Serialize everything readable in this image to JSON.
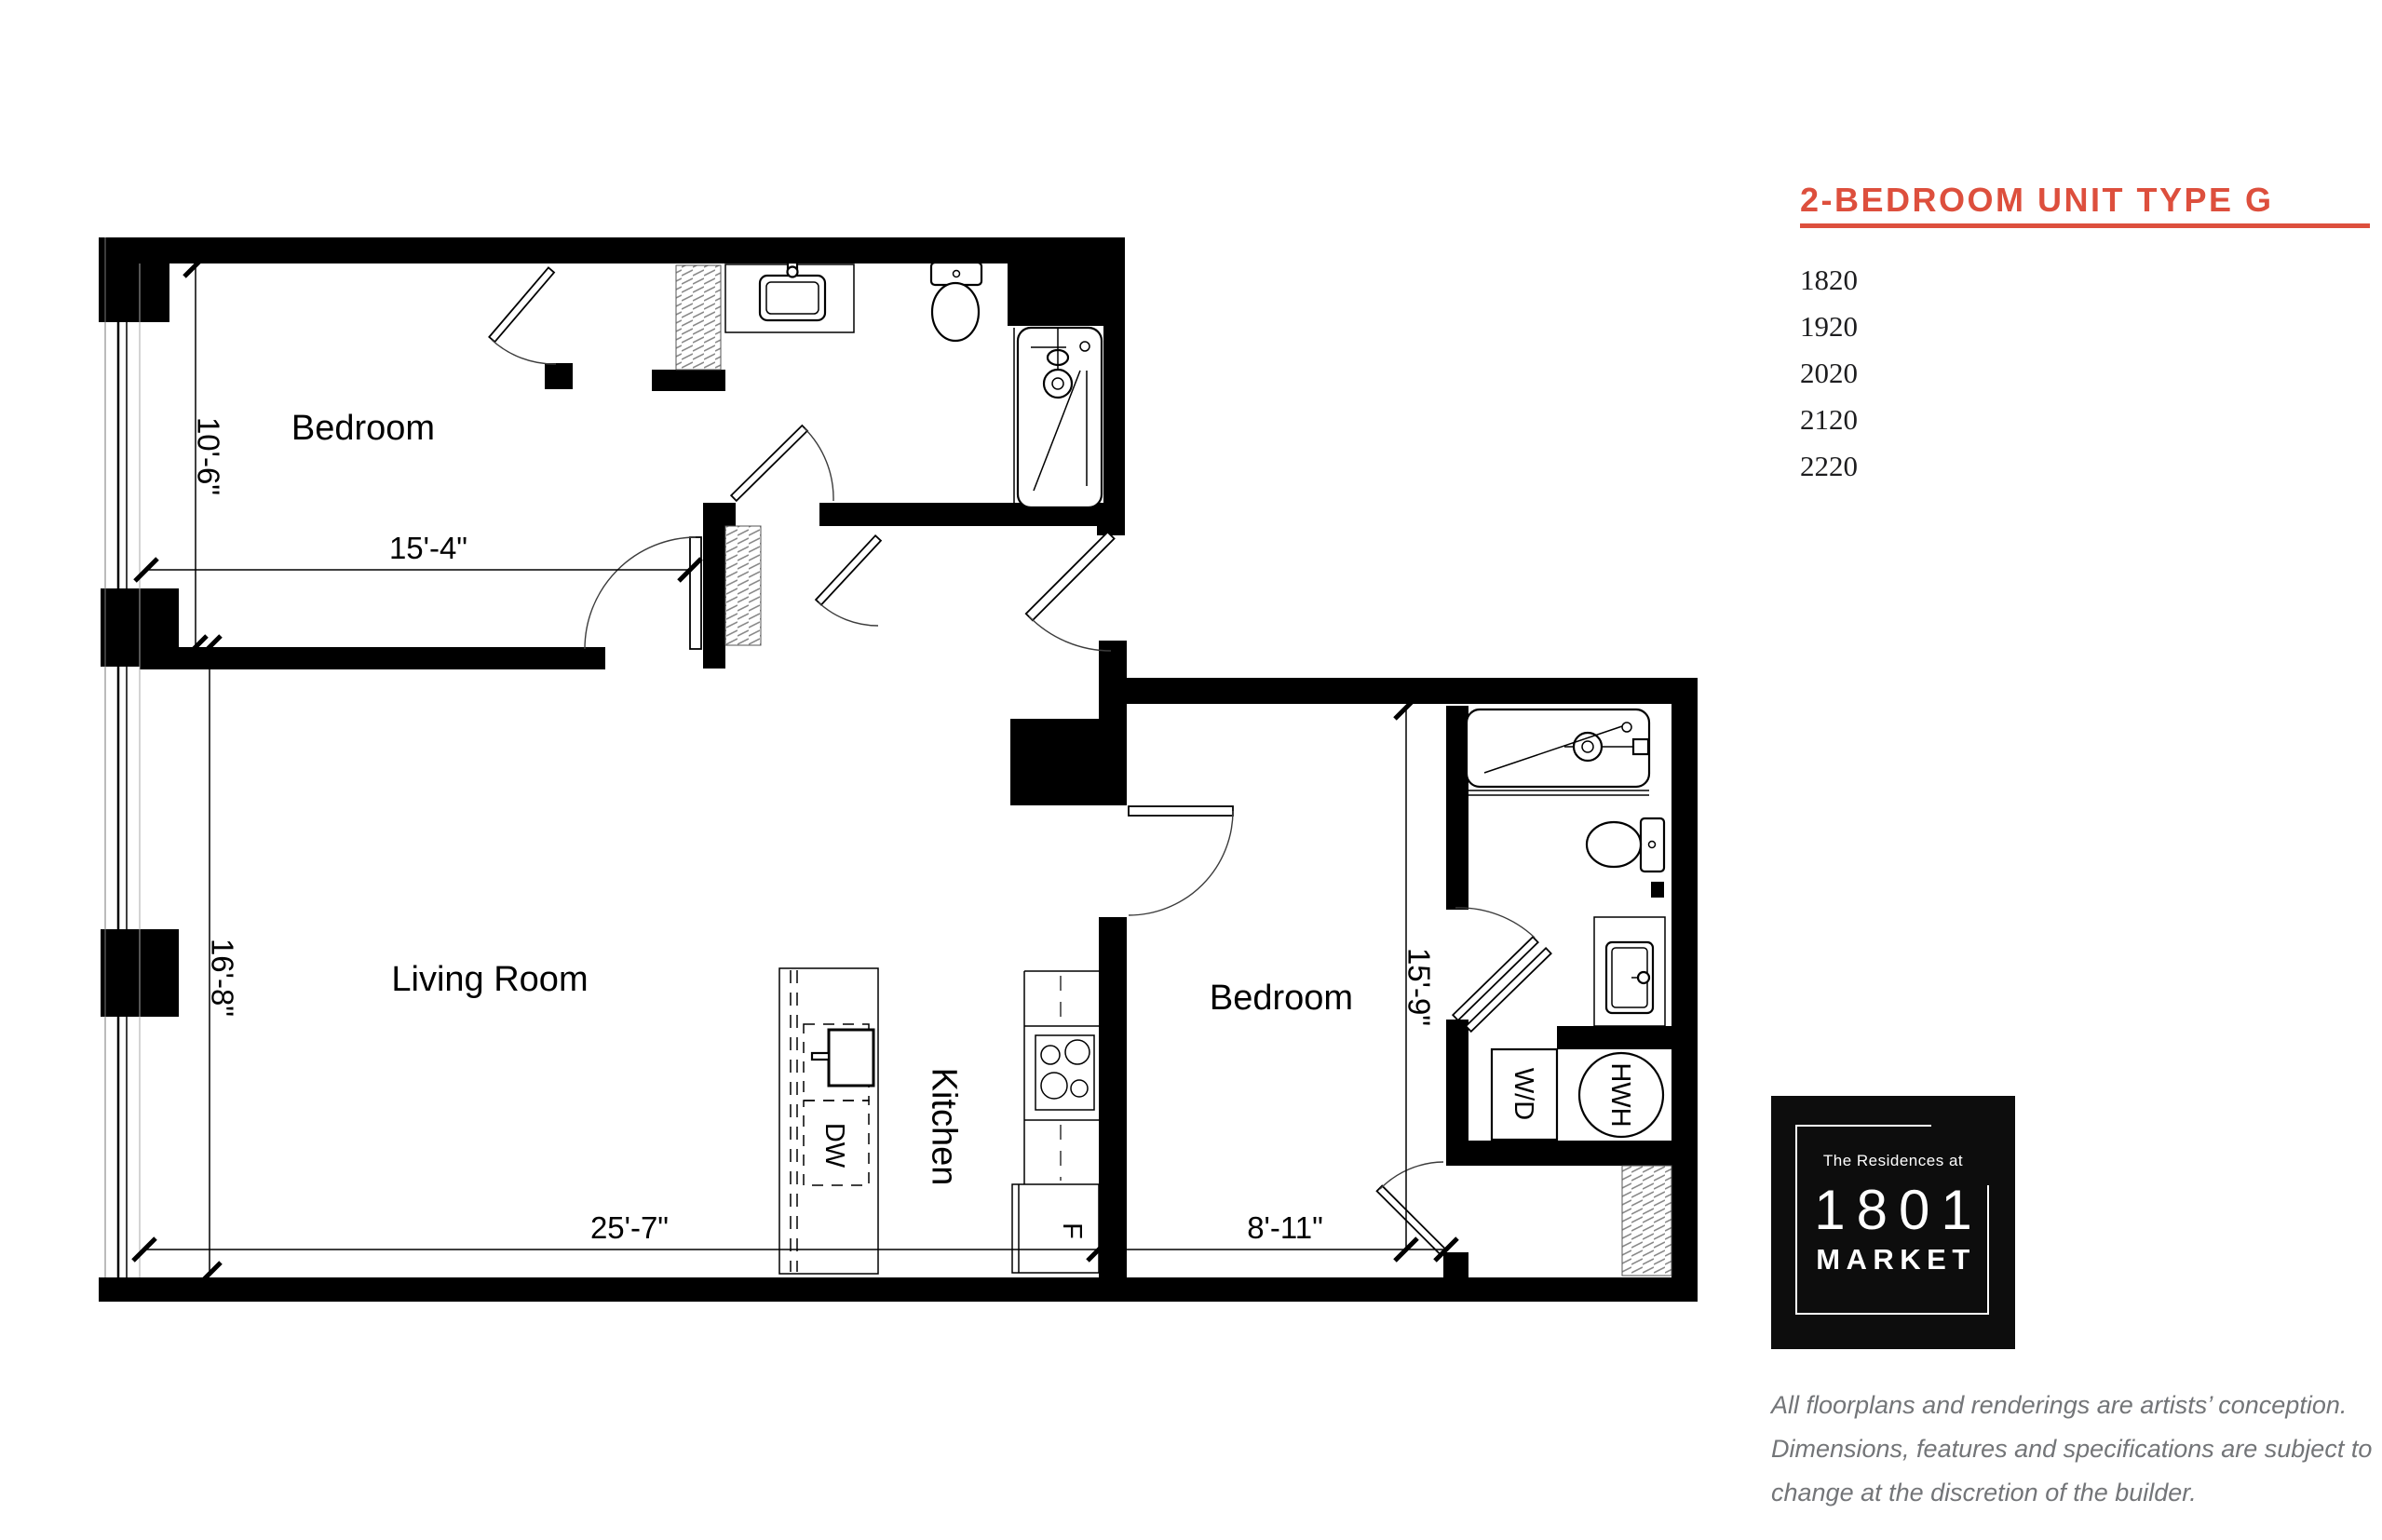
{
  "panel": {
    "title": "2-BEDROOM UNIT TYPE G",
    "units": [
      "1820",
      "1920",
      "2020",
      "2120",
      "2220"
    ],
    "logo": {
      "tagline": "The Residences at",
      "number": "1801",
      "name": "MARKET"
    },
    "disclaimer": [
      "All floorplans and renderings are artists’ conception.",
      "Dimensions, features and specifications are subject to",
      "change at the discretion of the builder."
    ]
  },
  "plan": {
    "rooms": {
      "bedroom1": "Bedroom",
      "living": "Living Room",
      "kitchen": "Kitchen",
      "bedroom2": "Bedroom"
    },
    "fixtures": {
      "dishwasher": "DW",
      "fridge": "F",
      "washer_dryer": "W/D",
      "water_heater": "HWH"
    },
    "dims": {
      "bed1_depth": "10'-6\"",
      "bed1_width": "15'-4\"",
      "living_depth": "16'-8\"",
      "living_width": "25'-7\"",
      "bed2_width": "8'-11\"",
      "bed2_depth": "15'-9\""
    }
  },
  "colors": {
    "accent": "#DD4F3D",
    "ink": "#000000",
    "disclaimer_gray": "#737578"
  }
}
